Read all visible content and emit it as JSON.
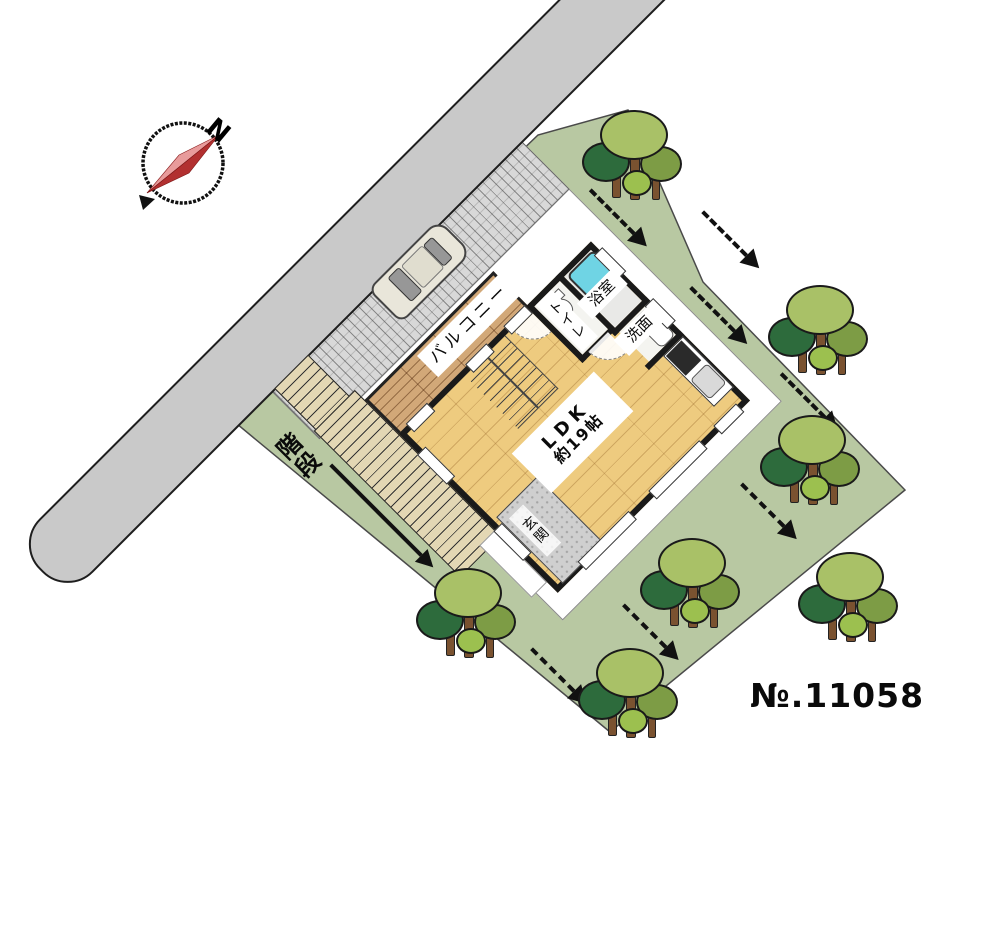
{
  "plan_number": "№.11058",
  "compass": {
    "north_label": "N"
  },
  "site": {
    "stairs_label": "階段",
    "colors": {
      "plot_green": "#b8c8a2",
      "road_gray": "#c9c9c9",
      "driveway_gray": "#d8d8d8",
      "floor_wood": "#eecb7f",
      "balcony_wood": "#d2a878",
      "bathtub_cyan": "#6fd4e4",
      "tree_light": "#a9c167",
      "tree_dark": "#2d6b3c",
      "tree_olive": "#7d9c45",
      "compass_needle_red": "#b23030"
    }
  },
  "floor_plan": {
    "rooms": {
      "balcony": {
        "label": "バルコニー"
      },
      "bath": {
        "label": "浴室"
      },
      "washroom": {
        "label": "洗面"
      },
      "toilet": {
        "label": "トイレ"
      },
      "ldk": {
        "name": "LDK",
        "size": "約19帖"
      },
      "entrance": {
        "label": "玄関"
      }
    }
  }
}
